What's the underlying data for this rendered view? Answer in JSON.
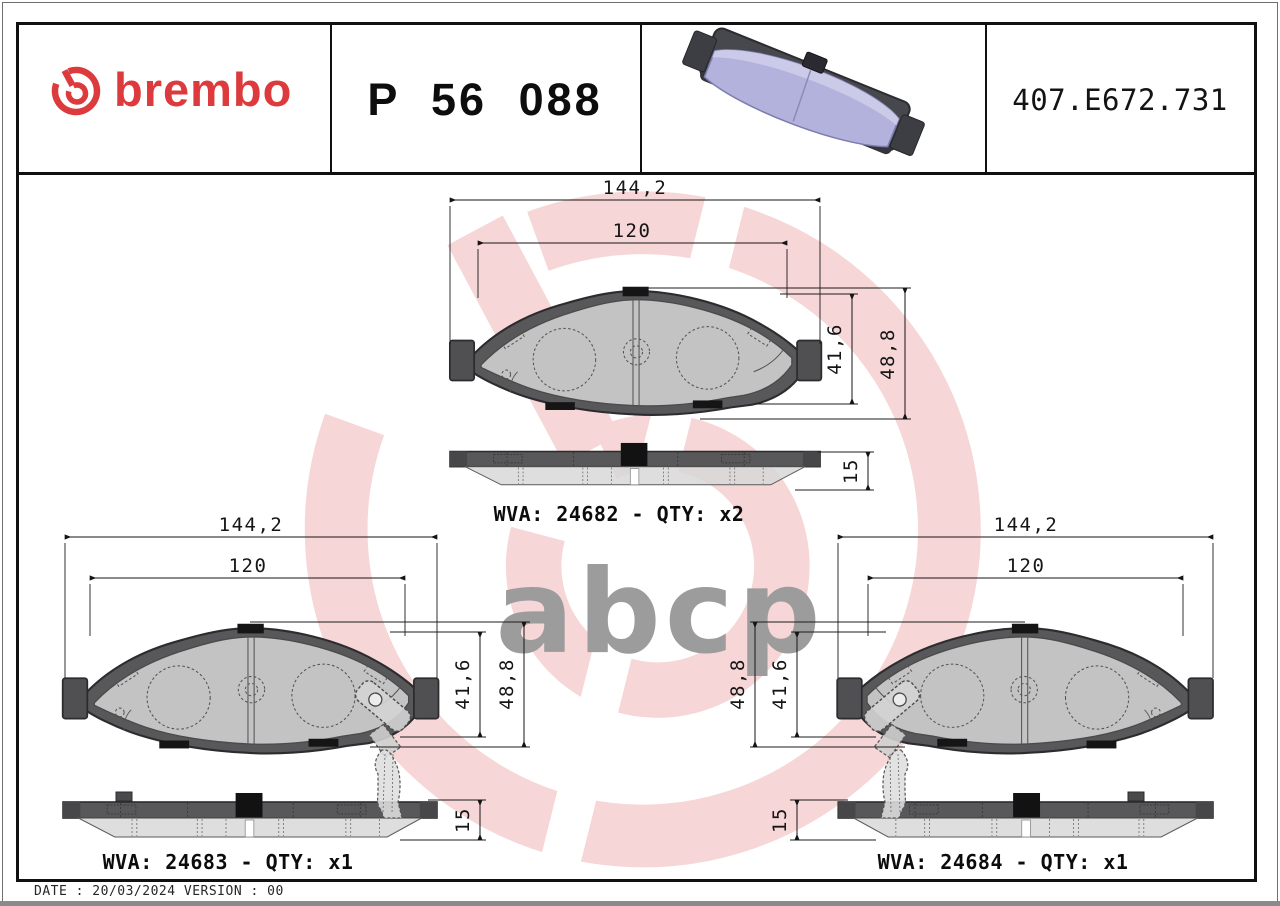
{
  "header": {
    "brand_wordmark": "brembo",
    "part_number": "P 56 088",
    "reference_number": "407.E672.731"
  },
  "watermark_text": "abcp",
  "drawings": {
    "top": {
      "overall_width": "144,2",
      "friction_width": "120",
      "inner_height": "41,6",
      "overall_height": "48,8",
      "thickness": "15",
      "wva_line": "WVA: 24682 - QTY: x2"
    },
    "bottom_left": {
      "overall_width": "144,2",
      "friction_width": "120",
      "inner_height": "41,6",
      "overall_height": "48,8",
      "thickness": "15",
      "wva_line": "WVA: 24683 - QTY: x1"
    },
    "bottom_right": {
      "overall_width": "144,2",
      "friction_width": "120",
      "inner_height": "41,6",
      "overall_height": "48,8",
      "thickness": "15",
      "wva_line": "WVA: 24684 - QTY: x1"
    }
  },
  "footer_line": "DATE : 20/03/2024 VERSION : 00",
  "colors": {
    "brand_red": "#dc3a3c",
    "watermark_pink": "#f6d6d6",
    "watermark_gray": "#9c9c9c",
    "pad_render_purple": "#b2b2dc",
    "backing_gray": "#58585a",
    "friction_gray": "#d8d8d8",
    "line_black": "#141414"
  }
}
